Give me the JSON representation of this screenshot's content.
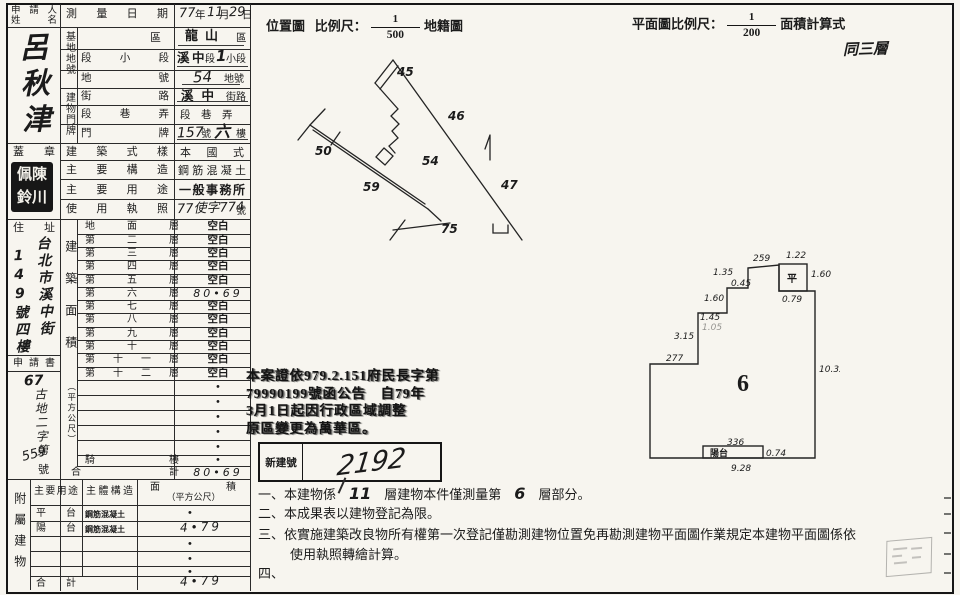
{
  "applicant": {
    "label_line1": "申請人",
    "label_line2": "姓　名",
    "name": "呂秋津",
    "seal_label": "蓋　章",
    "seal_chars": "佩陳鈴川"
  },
  "left": {
    "address_label": "住　址",
    "address_col1": "台北市溪中街",
    "address_col2": "149號四樓",
    "application_label": "申請書",
    "app_prefix": "67",
    "app_body": "古地二字第",
    "app_number": "559",
    "app_suffix": "號"
  },
  "survey": {
    "date_label": "測量日期",
    "date_year": "77",
    "u_year": "年",
    "date_month": "11",
    "u_month": "月",
    "date_day": "29",
    "u_day": "日",
    "site_group": "基地地號",
    "row_district_label": "區",
    "district_value": "龍山",
    "district_unit": "區",
    "row_section_label": "段小段",
    "section_v1": "溪",
    "section_v2": "中",
    "section_u1": "段",
    "section_v3": "1",
    "section_u2": "小段",
    "row_lot_label": "地號",
    "lot_value": "54",
    "lot_unit": "地號",
    "door_group": "建物門牌",
    "row_street_label": "街路",
    "street_value": "溪中",
    "street_unit": "街路",
    "row_lane_label": "段巷弄",
    "lane_value": "段　巷　弄",
    "row_door_label": "門牌",
    "door_v1": "157",
    "door_u1": "號",
    "door_v2": "六",
    "door_u2": "樓",
    "style_label": "建築式樣",
    "style_value": "本國式",
    "structure_label": "主要構造",
    "structure_value": "鋼筋混凝土",
    "use_label": "主要用途",
    "use_value": "一般事務所",
    "license_label": "使用執照",
    "license_value": "77使字774",
    "license_unit": "號"
  },
  "floor_area": {
    "group_label": "建築面積",
    "group_label_paren": "（平方公尺）",
    "rows": [
      {
        "label": "地面層",
        "value": "空白"
      },
      {
        "label": "第二層",
        "value": "空白"
      },
      {
        "label": "第三層",
        "value": "空白"
      },
      {
        "label": "第四層",
        "value": "空白"
      },
      {
        "label": "第五層",
        "value": "空白"
      },
      {
        "label": "第六層",
        "value": "80•69"
      },
      {
        "label": "第七層",
        "value": "空白"
      },
      {
        "label": "第八層",
        "value": "空白"
      },
      {
        "label": "第九層",
        "value": "空白"
      },
      {
        "label": "第十層",
        "value": "空白"
      },
      {
        "label": "第十一層",
        "value": "空白"
      },
      {
        "label": "第十二層",
        "value": "空白"
      },
      {
        "label": "",
        "value": "•"
      },
      {
        "label": "",
        "value": "•"
      },
      {
        "label": "",
        "value": "•"
      },
      {
        "label": "",
        "value": "•"
      },
      {
        "label": "",
        "value": "•"
      },
      {
        "label": "騎樓",
        "value": "•"
      },
      {
        "label": "合計",
        "value": "80•69"
      }
    ]
  },
  "annex": {
    "group_label": "附屬建物",
    "h_use": "主要用途",
    "h_structure": "主體構造",
    "h_area": "面積",
    "h_area_paren": "（平方公尺）",
    "rows": [
      {
        "use": "平台",
        "structure": "鋼筋混凝土",
        "area": "•"
      },
      {
        "use": "陽台",
        "structure": "鋼筋混凝土",
        "area": "4•79"
      },
      {
        "use": "",
        "structure": "",
        "area": "•"
      },
      {
        "use": "",
        "structure": "",
        "area": "•"
      },
      {
        "use": "",
        "structure": "",
        "area": "•"
      },
      {
        "use": "合計",
        "structure": "",
        "area": "4•79"
      }
    ]
  },
  "map": {
    "title": "位置圖",
    "scale_label": "比例尺：",
    "num": "1",
    "den": "500",
    "suffix": "地籍圖",
    "parcels": [
      "45",
      "46",
      "50",
      "54",
      "59",
      "47",
      "75"
    ]
  },
  "plan": {
    "scale_title": "平面圖比例尺：",
    "num": "1",
    "den": "200",
    "suffix": "面積計算式",
    "hand_note": "同三層",
    "floor_no": "6",
    "platform": "平",
    "balcony": "陽台",
    "dims": {
      "top": "259",
      "right_small": "1.22",
      "right_160": "1.60",
      "p079": "0.79",
      "left_135": "1.35",
      "left_045": "0.45",
      "left_160": "1.60",
      "left_145": "1.45",
      "left_105": "1.05",
      "left_315": "3.15",
      "left_277": "277",
      "right_1033": "10.33",
      "bot_336": "336",
      "bot_074": "0.74",
      "bot_928": "9.28"
    }
  },
  "stamp": {
    "l1": "本案證依979.2.151府民長字第",
    "l2": "79990199號函公告　自79年",
    "l3": "3月1日起因行政區域調整",
    "l4": "原區變更為萬華區。"
  },
  "newno": {
    "label": "新建號",
    "value": "2192"
  },
  "notes": {
    "n1a": "一、本建物係",
    "n1_num": "11",
    "n1b": "層建物本件僅測量第",
    "n1_num2": "6",
    "n1c": "層部分。",
    "n2": "二、本成果表以建物登記為限。",
    "n3": "三、依實施建築改良物所有權第一次登記僅勘測建物位置免再勘測建物平面圖作業規定本建物平面圖係依",
    "n3b": "使用執照轉繪計算。",
    "n4": "四、"
  }
}
